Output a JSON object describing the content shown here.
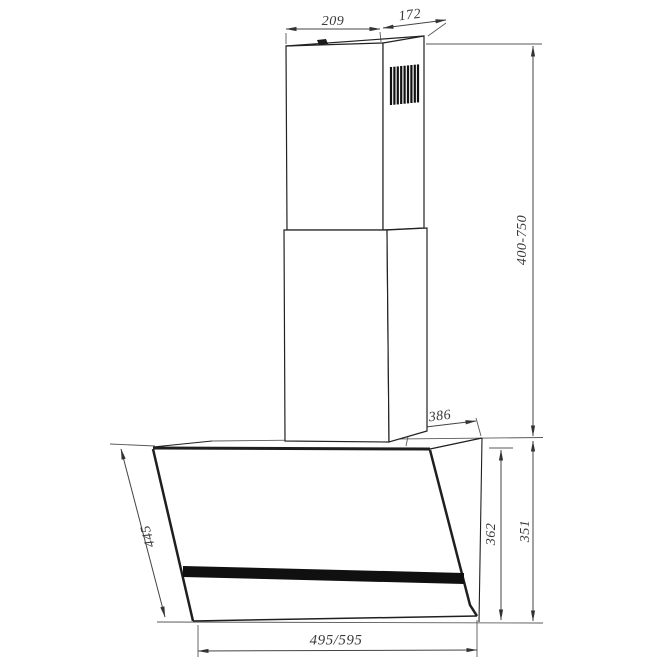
{
  "drawing": {
    "dims": {
      "chimney_top_width": "209",
      "chimney_top_depth": "172",
      "chimney_height_range": "400-750",
      "hood_top_depth": "386",
      "glass_length": "445",
      "front_height": "362",
      "rear_height": "351",
      "hood_width": "495/595"
    }
  }
}
